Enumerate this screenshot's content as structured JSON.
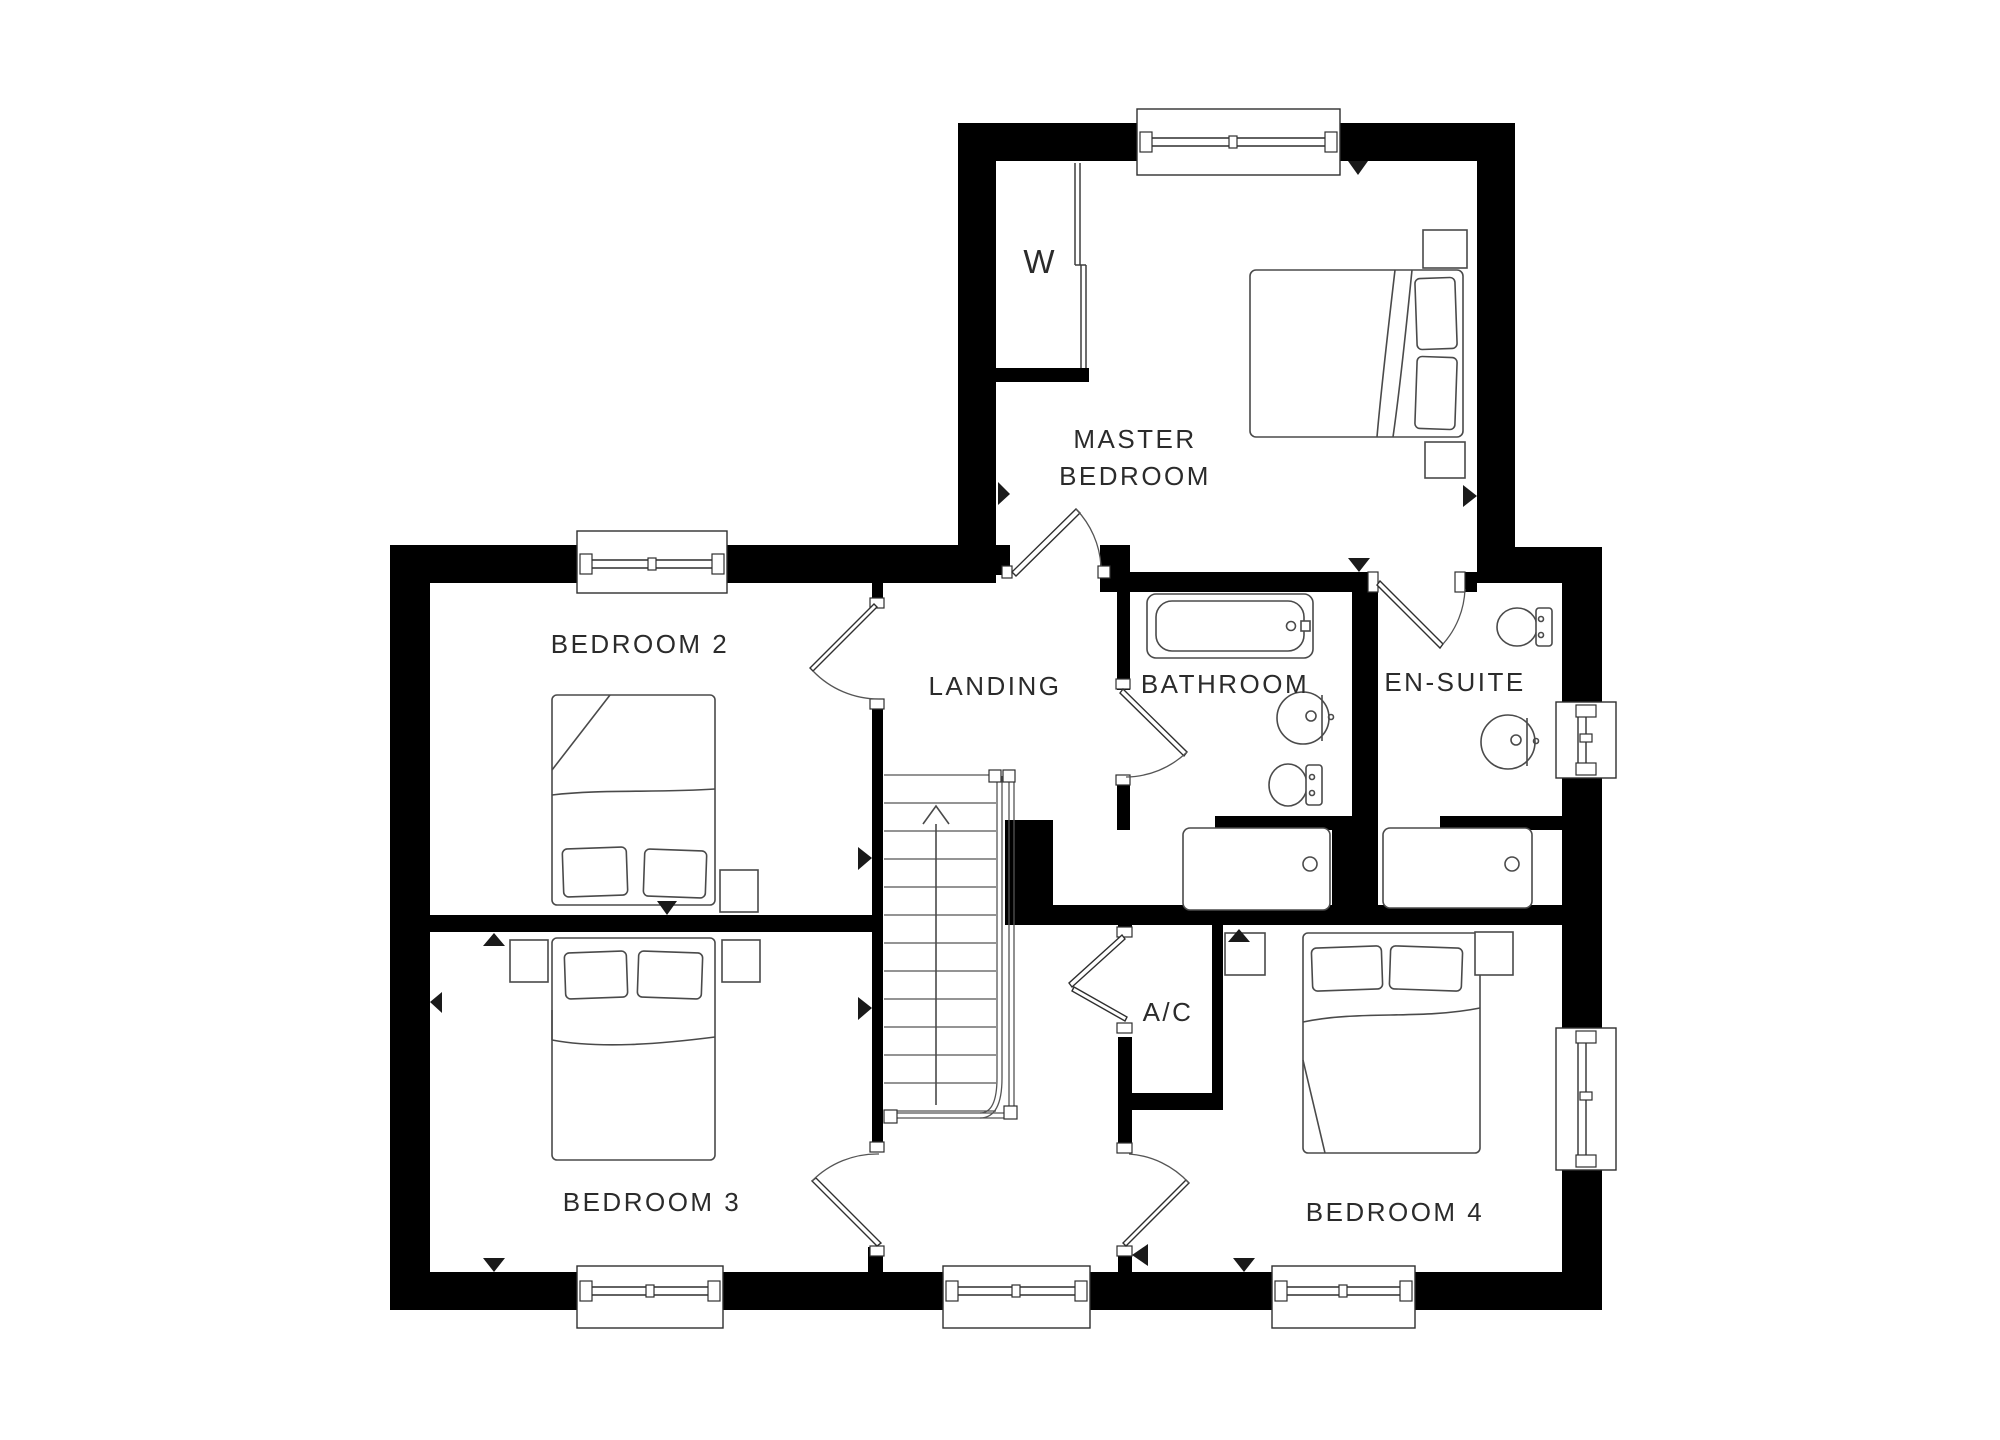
{
  "plan": {
    "title": "First floor plan",
    "rooms": {
      "master_bedroom": {
        "line1": "MASTER",
        "line2": "BEDROOM"
      },
      "bedroom2": {
        "label": "BEDROOM 2"
      },
      "bedroom3": {
        "label": "BEDROOM 3"
      },
      "bedroom4": {
        "label": "BEDROOM 4"
      },
      "landing": {
        "label": "LANDING"
      },
      "bathroom": {
        "label": "BATHROOM"
      },
      "ensuite": {
        "label": "EN-SUITE"
      },
      "ac_cupboard": {
        "label": "A/C"
      },
      "wardrobe": {
        "label": "W"
      }
    },
    "colors": {
      "wall": "#000000",
      "furniture_line": "#4a4a4a",
      "background": "#ffffff",
      "text": "#2b2b2b"
    }
  }
}
